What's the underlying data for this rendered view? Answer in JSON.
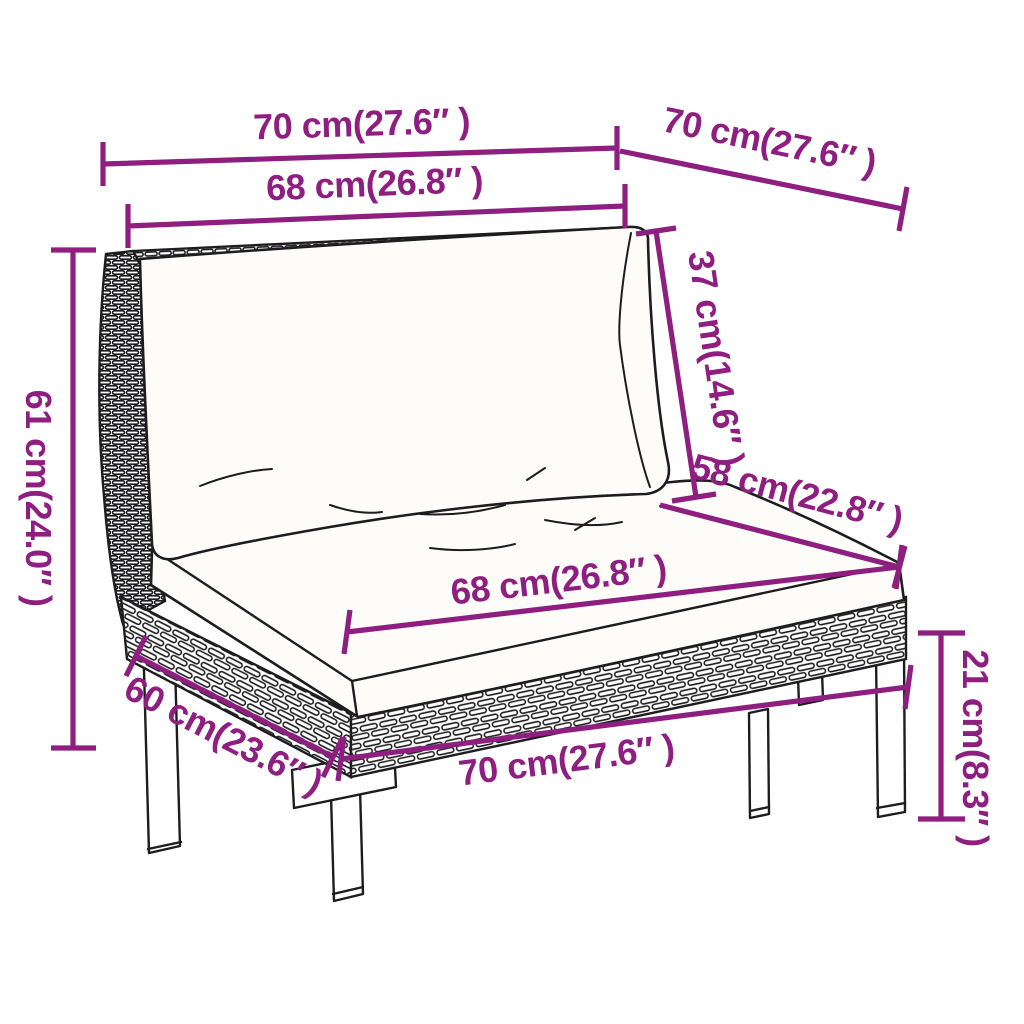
{
  "page": {
    "background": "#ffffff",
    "kind": "product dimension diagram",
    "subject": "poly rattan garden sofa middle section with back and seat cushions"
  },
  "style": {
    "dimension_color": "#8E1F80",
    "line_art_color": "#1d1d1f"
  },
  "dimensions": {
    "top_width": "70 cm(27.6″ )",
    "top_depth": "70 cm(27.6″ )",
    "back_width": "68 cm(26.8″ )",
    "back_cushion_height": "37 cm(14.6″ )",
    "seat_depth": "58 cm(22.8″ )",
    "seat_width": "68 cm(26.8″ )",
    "leg_height": "21 cm(8.3″ )",
    "front_width": "70 cm(27.6″ )",
    "side_depth": "60 cm(23.6″ )",
    "total_height": "61 cm(24.0″ )"
  }
}
